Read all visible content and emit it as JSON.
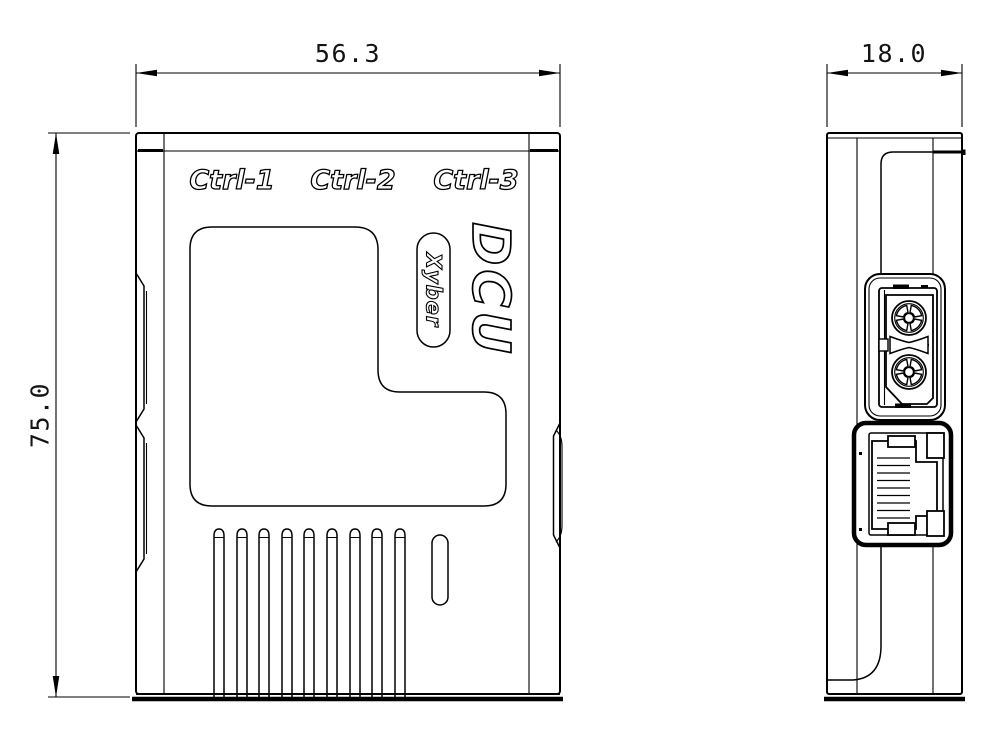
{
  "drawing": {
    "background": "#ffffff",
    "line_color": "#000000",
    "front_view": {
      "port_labels": [
        "Ctrl-1",
        "Ctrl-2",
        "Ctrl-3"
      ],
      "product_name": "DCU",
      "brand": "Xyber",
      "width_dim": "56.3",
      "height_dim": "75.0",
      "vent_slats": 9
    },
    "side_view": {
      "depth_dim": "18.0"
    }
  }
}
